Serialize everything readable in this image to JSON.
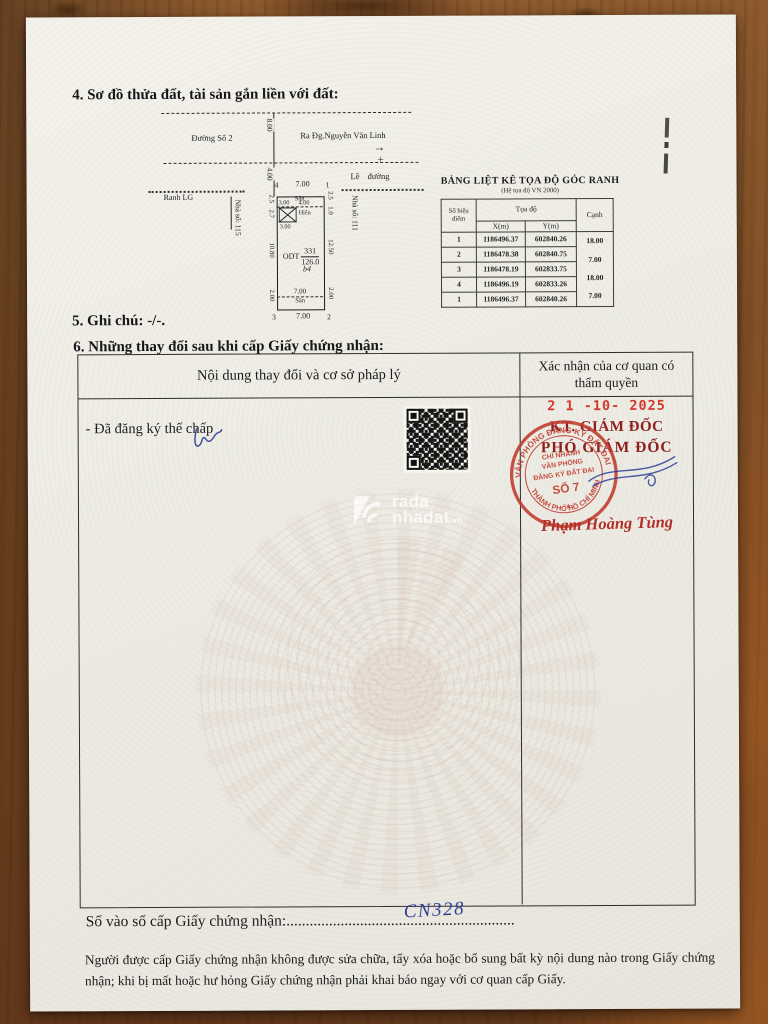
{
  "sections": {
    "s4": "4. Sơ đồ thửa đất, tài sản gắn liền với đất:",
    "s5": "5. Ghi chú: -/-.",
    "s6": "6. Những thay đổi sau khi cấp Giấy chứng nhận:"
  },
  "diagram": {
    "street": "Đường Số 2",
    "direction": "Ra Đg.Nguyễn Văn Linh",
    "road_width": "8.00",
    "setback": "4.00",
    "curb": "Lề đường",
    "boundary": "Ranh LG",
    "house_left": "Nhà số: 115",
    "house_right": "Nhà số: 111",
    "corner_tl": "4",
    "corner_tr": "1",
    "corner_br": "2",
    "corner_bl": "3",
    "front_edge": "7.00",
    "rear_edge": "7.00",
    "yard_front": "Sân",
    "yard_rear": "Sân",
    "yard_rear_width": "7.00",
    "porch_w1": "3.00",
    "porch_w2": "4.00",
    "porch_w3": "3.00",
    "porch": "Hiên",
    "left_d1": "2.5",
    "left_d2": "2.7",
    "left_d3": "10.80",
    "left_d4": "2.00",
    "right_d1": "2.5",
    "right_d2": "1.0",
    "right_d3": "12.50",
    "right_d4": "2.00",
    "land_type": "ODT",
    "plot_no": "331",
    "area": "126.0",
    "block": "b4"
  },
  "icons": {
    "direction_arrow": "→",
    "survey_cross": "+",
    "star": "★"
  },
  "coord_table": {
    "title": "BẢNG LIỆT KÊ TỌA ĐỘ GÓC RANH",
    "subtitle": "(Hệ tọa độ VN 2000)",
    "col_point": "Số hiệu điểm",
    "col_coord": "Tọa độ",
    "col_x": "X(m)",
    "col_y": "Y(m)",
    "col_edge": "Cạnh",
    "rows": [
      {
        "p": "1",
        "x": "1186496.37",
        "y": "602840.26"
      },
      {
        "p": "2",
        "x": "1186478.38",
        "y": "602840.75"
      },
      {
        "p": "3",
        "x": "1186478.19",
        "y": "602833.75"
      },
      {
        "p": "4",
        "x": "1186496.19",
        "y": "602833.26"
      },
      {
        "p": "1",
        "x": "1186496.37",
        "y": "602840.26"
      }
    ],
    "edges": [
      "18.00",
      "7.00",
      "18.00",
      "7.00"
    ]
  },
  "changes": {
    "col_left": "Nội dung thay đổi và cơ sở pháp lý",
    "col_right": "Xác nhận của cơ quan có thẩm quyền",
    "entry": "- Đã đăng ký thế chấp",
    "stamp_date": "2 1 -10- 2025",
    "kt": "KT. GIÁM ĐỐC",
    "pho": "PHÓ GIÁM ĐỐC",
    "seal_ring_top": "VĂN PHÒNG ĐĂNG KÝ ĐẤT ĐAI",
    "seal_ring_bottom": "THÀNH PHỐ HỒ CHÍ MINH",
    "seal_center1": "CHI NHÁNH",
    "seal_center2": "VĂN PHÒNG",
    "seal_center3": "ĐĂNG KÝ ĐẤT ĐAI",
    "seal_center4": "SỐ 7",
    "signer": "Phạm Hoàng Tùng"
  },
  "watermark": {
    "brand1": "rada",
    "brand2": "nhadat",
    "tld": ".vn"
  },
  "registry": {
    "label": "Số vào sổ cấp Giấy chứng nhận:",
    "dots": "...........................................................",
    "number": "CN328"
  },
  "notice": "Người được cấp Giấy chứng nhận không được sửa chữa, tẩy xóa hoặc bổ sung bất kỳ nội dung nào trong Giấy chứng nhận; khi bị mất hoặc hư hỏng Giấy chứng nhận phải khai báo ngay với cơ quan cấp Giấy.",
  "colors": {
    "stamp_red": "#c03a2c",
    "date_red": "#d2382a",
    "title_maroon": "#8d1e1c",
    "ink_blue": "#2e3f96",
    "paper": "#efeee6",
    "wood": "#7d4a23"
  }
}
